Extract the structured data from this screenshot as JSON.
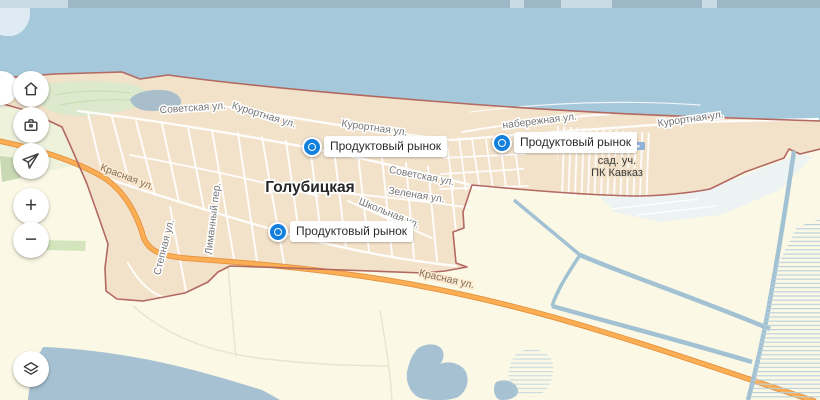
{
  "map": {
    "town": {
      "label": "Голубицкая"
    },
    "garden_area": {
      "line1": "сад. уч.",
      "line2": "ПК Кавказ"
    },
    "streets": [
      {
        "text": "Советская ул."
      },
      {
        "text": "Курортная ул."
      },
      {
        "text": "Курортная ул."
      },
      {
        "text": "набережная ул."
      },
      {
        "text": "Курортная ул."
      },
      {
        "text": "Советская ул."
      },
      {
        "text": "Зеленая ул."
      },
      {
        "text": "Школьная ул."
      },
      {
        "text": "Красная ул."
      },
      {
        "text": "Красная ул."
      },
      {
        "text": "Лиманный пер."
      },
      {
        "text": "Степная ул."
      }
    ],
    "markers": [
      {
        "label": "Продуктовый рынок"
      },
      {
        "label": "Продуктовый рынок"
      },
      {
        "label": "Продуктовый рынок"
      }
    ],
    "poi": {
      "bus_stop_icon": "bus-stop-icon"
    }
  },
  "controls": {
    "home": {
      "icon": "home-icon"
    },
    "bookmarks": {
      "icon": "briefcase-icon"
    },
    "location": {
      "icon": "navigation-arrow-icon"
    },
    "zoom_in": {
      "icon": "plus-icon",
      "glyph": "+"
    },
    "zoom_out": {
      "icon": "minus-icon",
      "glyph": "−"
    },
    "layers": {
      "icon": "layers-icon"
    }
  },
  "colors": {
    "water": "#a6c8db",
    "settlement": "#f3e2ca",
    "fields": "#fbf8e6",
    "fields_green": "#eef2db",
    "boundary": "#b06a63",
    "road_orange": "#fcae54",
    "road_casing": "#e2923d",
    "canal": "#a2c2d3",
    "marker_blue": "#1480dd"
  }
}
